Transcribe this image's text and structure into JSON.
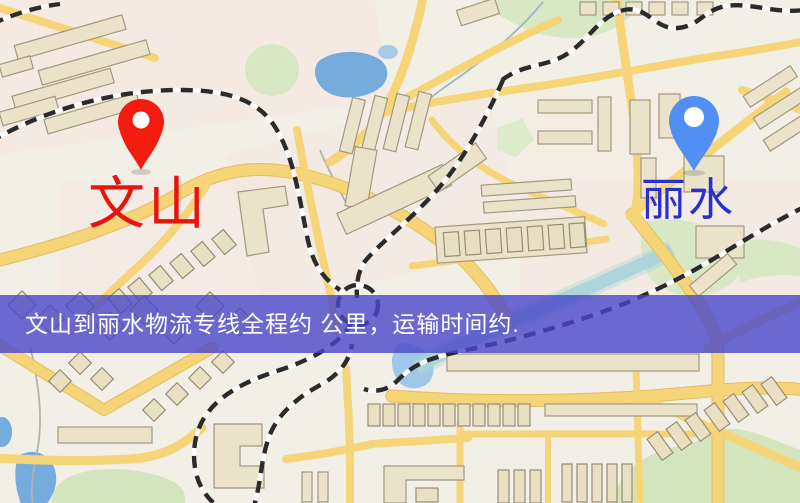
{
  "map": {
    "origin": {
      "label": "文山",
      "pin_color": "#f31a10",
      "label_color": "#e9130b"
    },
    "destination": {
      "label": "丽水",
      "pin_color": "#5190f2",
      "label_color": "#2a2fd0"
    },
    "banner": {
      "text": "文山到丽水物流专线全程约 公里，运输时间约.",
      "text_color": "#ffffff",
      "bg_color": "#4947CA",
      "bg_opacity": 0.8
    },
    "palette": {
      "background": "#f2efe7",
      "road": "#f6d478",
      "building": "#ebe3c9",
      "water": "#76abdd",
      "park": "#d8e8c4",
      "railway": "#2b2b2b"
    }
  }
}
